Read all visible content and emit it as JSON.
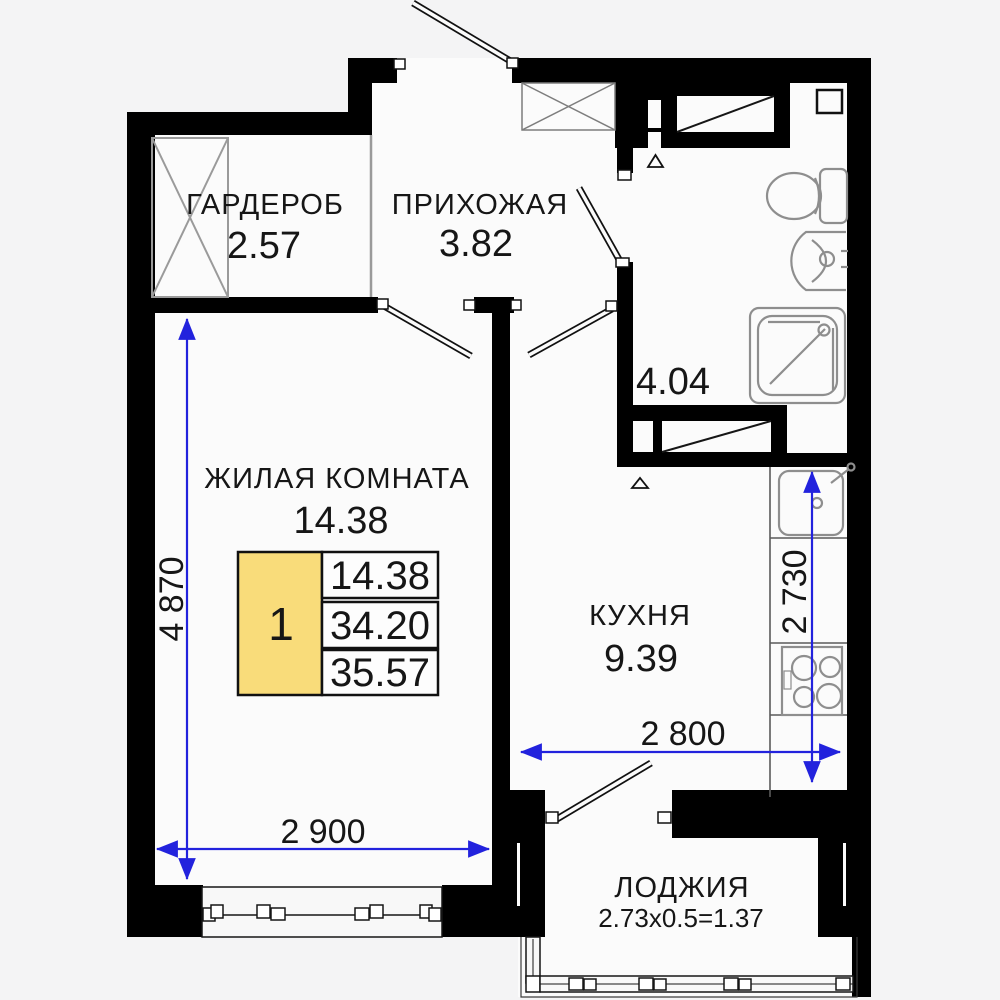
{
  "plan_title": "Apartment floor plan",
  "colors": {
    "background_outside": "#f4f4f5",
    "room_fill": "#fbfbfb",
    "wall": "#000000",
    "dimension_blue": "#2222dd",
    "legend_yellow": "#f9dc7a",
    "fixture_gray": "#8e8e8e"
  },
  "rooms": {
    "wardrobe": {
      "name": "ГАРДЕРОБ",
      "area": "2.57"
    },
    "hallway": {
      "name": "ПРИХОЖАЯ",
      "area": "3.82"
    },
    "bathroom": {
      "area": "4.04"
    },
    "living": {
      "name": "ЖИЛАЯ КОМНАТА",
      "area": "14.38"
    },
    "kitchen": {
      "name": "КУХНЯ",
      "area": "9.39"
    },
    "loggia": {
      "name": "ЛОДЖИЯ",
      "calc": "2.73x0.5=1.37"
    }
  },
  "legend": {
    "unit_number": "1",
    "living_area": "14.38",
    "apartment_area": "34.20",
    "total_area": "35.57"
  },
  "dimensions": {
    "living_width": "2 900",
    "living_height": "4 870",
    "kitchen_width": "2 800",
    "kitchen_height": "2 730"
  }
}
